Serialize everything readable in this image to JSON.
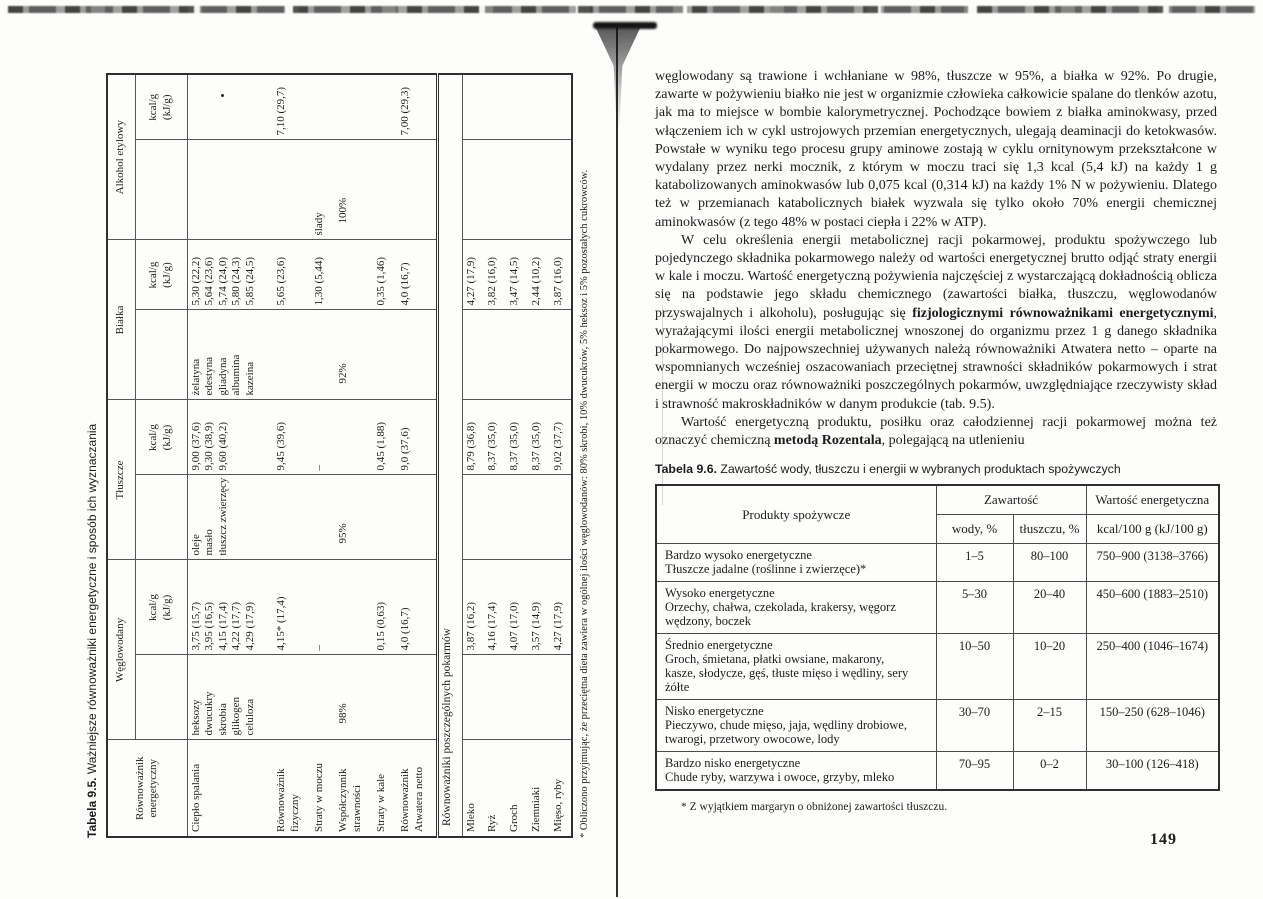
{
  "colors": {
    "paper": "#fdfdfb",
    "ink": "#1c1c1c"
  },
  "page_number": "149",
  "table95": {
    "caption_bold": "Tabela 9.5.",
    "caption_rest": " Ważniejsze równoważniki energetyczne i sposób ich wyznaczania",
    "row_header": "Równoważnik\nenergetyczny",
    "groups": [
      {
        "label": "Węglowodany",
        "unit": "kcal/g\n(kJ/g)"
      },
      {
        "label": "Tłuszcze",
        "unit": "kcal/g\n(kJ/g)"
      },
      {
        "label": "Białka",
        "unit": "kcal/g\n(kJ/g)"
      },
      {
        "label": "Alkohol etylowy",
        "unit": "kcal/g\n(kJ/g)"
      }
    ],
    "rows": [
      {
        "label": "Ciepło spalania",
        "cells": [
          "heksozy\ndwucukry\nskrobia\nglikogen\nceluloza",
          "3,75 (15,7)\n3,95 (16,5)\n4,15 (17,4)\n4,22 (17,7)\n4,29 (17,9)",
          "oleje\nmasło\ntłuszcz zwierzęcy",
          "9,00 (37,6)\n9,30 (38,9)\n9,60 (40,2)",
          "żelatyna\nedestyna\ngliadyna\nalbumina\nkazeina",
          "5,30 (22,2)\n5,64 (23,6)\n5,74 (24,0)\n5,80 (24,3)\n5,85 (24,5)",
          "",
          ""
        ]
      },
      {
        "label": "Równoważnik\nfizyczny",
        "cells": [
          "",
          "4,15* (17,4)",
          "",
          "9,45 (39,6)",
          "",
          "5,65 (23,6)",
          "",
          "7,10 (29,7)"
        ]
      },
      {
        "label": "Straty w moczu",
        "cells": [
          "",
          "–",
          "",
          "–",
          "",
          "1,30 (5,44)",
          "ślady",
          ""
        ]
      },
      {
        "label": "Współczynnik\nstrawności",
        "cells": [
          "98%",
          "",
          "95%",
          "",
          "92%",
          "",
          "100%",
          ""
        ]
      },
      {
        "label": "Straty w kale",
        "cells": [
          "",
          "0,15 (0,63)",
          "",
          "0,45 (1,88)",
          "",
          "0,35 (1,46)",
          "",
          ""
        ]
      },
      {
        "label": "Równoważnik\nAtwatera netto",
        "cells": [
          "",
          "4,0 (16,7)",
          "",
          "9,0 (37,6)",
          "",
          "4,0 (16,7)",
          "",
          "7,00 (29,3)"
        ]
      }
    ],
    "section_header": "Równoważniki poszczególnych pokarmów",
    "food_rows": [
      {
        "label": "Mleko",
        "cells": [
          "",
          "3,87 (16,2)",
          "",
          "8,79 (36,8)",
          "",
          "4,27 (17,9)",
          "",
          ""
        ]
      },
      {
        "label": "Ryż",
        "cells": [
          "",
          "4,16 (17,4)",
          "",
          "8,37 (35,0)",
          "",
          "3,82 (16,0)",
          "",
          ""
        ]
      },
      {
        "label": "Groch",
        "cells": [
          "",
          "4,07 (17,0)",
          "",
          "8,37 (35,0)",
          "",
          "3,47 (14,5)",
          "",
          ""
        ]
      },
      {
        "label": "Ziemniaki",
        "cells": [
          "",
          "3,57 (14,9)",
          "",
          "8,37 (35,0)",
          "",
          "2,44 (10,2)",
          "",
          ""
        ]
      },
      {
        "label": "Mięso, ryby",
        "cells": [
          "",
          "4,27 (17,9)",
          "",
          "9,02 (37,7)",
          "",
          "3,87 (16,0)",
          "",
          ""
        ]
      }
    ],
    "footnote": "* Obliczono przyjmując, że przeciętna dieta zawiera w ogólnej ilości węglowodanów: 80% skrobi, 10% dwucukrów, 5% heksoz i 5% pozostałych cukrowców."
  },
  "right_page": {
    "paragraphs": [
      {
        "indent": false,
        "segments": [
          {
            "text": "węglowodany są trawione i wchłaniane w 98%, tłuszcze w 95%, a białka w 92%. Po drugie, zawarte w pożywieniu białko nie jest w organizmie człowieka całkowicie spalane do tlenków azotu, jak ma to miejsce w bombie kalorymetrycznej. Pochodzące bowiem z białka aminokwasy, przed włączeniem ich w cykl ustrojowych przemian energetycznych, ulegają deaminacji do ketokwasów. Powstałe w wyniku tego procesu grupy aminowe zostają w cyklu ornitynowym przekształcone w wydalany przez nerki mocznik, z którym w moczu traci się 1,3 kcal (5,4 kJ) na każdy 1 g katabolizowanych aminokwasów lub 0,075 kcal (0,314 kJ) na każdy 1% N w pożywieniu. Dlatego też w przemianach katabolicznych białek wyzwala się tylko około 70% energii chemicznej aminokwasów (z tego 48% w postaci ciepła i 22% w ATP)."
          }
        ]
      },
      {
        "indent": true,
        "segments": [
          {
            "text": "W celu określenia energii metabolicznej racji pokarmowej, produktu spożywczego lub pojedynczego składnika pokarmowego należy od wartości energetycznej brutto odjąć straty energii w kale i moczu. Wartość energetyczną pożywienia najczęściej z wystarczającą dokładnością oblicza się na podstawie jego składu chemicznego (zawartości białka, tłuszczu, węglowodanów przyswajalnych i alkoholu), posługując się "
          },
          {
            "text": "fizjologicznymi równoważnikami energetycznymi",
            "bold": true
          },
          {
            "text": ", wyrażającymi ilości energii metabolicznej wnoszonej do organizmu przez 1 g danego składnika pokarmowego. Do najpowszechniej używanych należą równoważniki Atwatera netto – oparte na wspomnianych wcześniej oszacowaniach przeciętnej strawności składników pokarmowych i strat energii w moczu oraz równoważniki poszczególnych pokarmów, uwzględniające rzeczywisty skład i strawność makroskładników w danym produkcie (tab. 9.5)."
          }
        ]
      },
      {
        "indent": true,
        "segments": [
          {
            "text": "Wartość energetyczną produktu, posiłku oraz całodziennej racji pokarmowej można też oznaczyć chemiczną "
          },
          {
            "text": "metodą Rozentala",
            "bold": true
          },
          {
            "text": ", polegającą na utlenieniu"
          }
        ]
      }
    ]
  },
  "table96": {
    "caption_bold": "Tabela 9.6.",
    "caption_rest": " Zawartość wody, tłuszczu i energii w wybranych produktach spożywczych",
    "headers": {
      "products": "Produkty spożywcze",
      "content_group": "Zawartość",
      "energy_group": "Wartość energetyczna",
      "water": "wody, %",
      "fat": "tłuszczu, %",
      "kcal": "kcal/100 g (kJ/100 g)"
    },
    "rows": [
      {
        "product": "Bardzo wysoko energetyczne\nTłuszcze jadalne (roślinne i zwierzęce)*",
        "water": "1–5",
        "fat": "80–100",
        "energy": "750–900 (3138–3766)"
      },
      {
        "product": "Wysoko energetyczne\nOrzechy, chałwa, czekolada, krakersy, węgorz\nwędzony, boczek",
        "water": "5–30",
        "fat": "20–40",
        "energy": "450–600 (1883–2510)"
      },
      {
        "product": "Średnio energetyczne\nGroch, śmietana, płatki owsiane, makarony,\nkasze, słodycze, gęś, tłuste mięso i wędliny, sery\nżółte",
        "water": "10–50",
        "fat": "10–20",
        "energy": "250–400 (1046–1674)"
      },
      {
        "product": "Nisko energetyczne\nPieczywo, chude mięso, jaja, wędliny drobiowe,\ntwarogi, przetwory owocowe, lody",
        "water": "30–70",
        "fat": "2–15",
        "energy": "150–250 (628–1046)"
      },
      {
        "product": "Bardzo nisko energetyczne\nChude ryby, warzywa i owoce, grzyby, mleko",
        "water": "70–95",
        "fat": "0–2",
        "energy": "30–100 (126–418)"
      }
    ],
    "footnote": "* Z wyjątkiem margaryn o obniżonej zawartości tłuszczu."
  }
}
